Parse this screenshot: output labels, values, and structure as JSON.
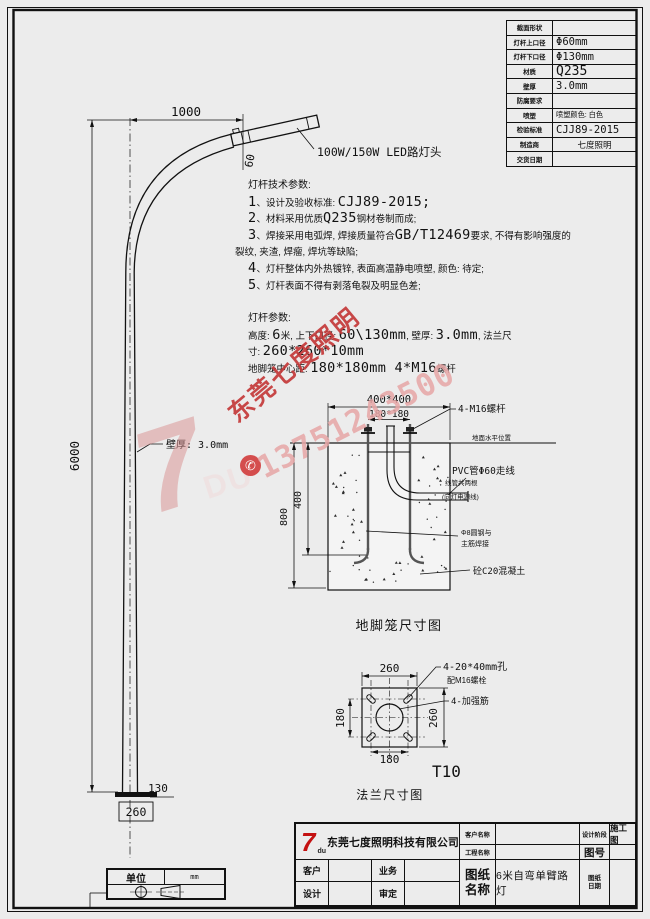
{
  "spec_table": {
    "rows": [
      {
        "label": "截面形状",
        "value": "",
        "cls": "v-cad"
      },
      {
        "label": "灯杆上口径",
        "value": "Φ60mm",
        "cls": "v-cad"
      },
      {
        "label": "灯杆下口径",
        "value": "Φ130mm",
        "cls": "v-cad"
      },
      {
        "label": "材质",
        "value": "Q235",
        "cls": "v-cad-lg"
      },
      {
        "label": "壁厚",
        "value": "3.0mm",
        "cls": "v-cad"
      },
      {
        "label": "防腐要求",
        "value": "",
        "cls": "v-cad"
      },
      {
        "label": "喷塑",
        "value": "喷塑颜色: 白色",
        "cls": "v-zh"
      },
      {
        "label": "检验标准",
        "value": "CJJ89-2015",
        "cls": "v-cad"
      },
      {
        "label": "制造商",
        "value": "七度照明",
        "cls": "v-zh-c"
      },
      {
        "label": "交货日期",
        "value": "",
        "cls": "v-cad"
      }
    ]
  },
  "tech_notes": {
    "title": "灯杆技术参数:",
    "lines": [
      [
        {
          "t": "1",
          "c": "L"
        },
        {
          "t": "、设计及验收标准: ",
          "c": "z"
        },
        {
          "t": "CJJ89-2015;",
          "c": "L"
        }
      ],
      [
        {
          "t": "2",
          "c": "L"
        },
        {
          "t": "、材料采用优质",
          "c": "z"
        },
        {
          "t": "Q235",
          "c": "L"
        },
        {
          "t": "钢材卷制而成;",
          "c": "z"
        }
      ],
      [
        {
          "t": "3",
          "c": "L"
        },
        {
          "t": "、焊接采用电弧焊, 焊接质量符合",
          "c": "z"
        },
        {
          "t": "GB/T12469",
          "c": "L"
        },
        {
          "t": "要求, 不得有影响强度的",
          "c": "z"
        }
      ],
      [
        {
          "t": "裂纹, 夹渣, 焊瘤, 焊坑等缺陷;",
          "c": "z"
        }
      ],
      [
        {
          "t": "4",
          "c": "L"
        },
        {
          "t": "、灯杆整体内外热镀锌, 表面高温静电喷塑, 颜色: 待定;",
          "c": "z"
        }
      ],
      [
        {
          "t": "5",
          "c": "L"
        },
        {
          "t": "、灯杆表面不得有剥落龟裂及明显色差;",
          "c": "z"
        }
      ]
    ]
  },
  "pole_params": {
    "title": "灯杆参数:",
    "lines": [
      [
        {
          "t": "高度: ",
          "c": "z"
        },
        {
          "t": "6",
          "c": "L"
        },
        {
          "t": "米, 上下口径: ",
          "c": "z"
        },
        {
          "t": "60\\130mm",
          "c": "L"
        },
        {
          "t": ", 壁厚: ",
          "c": "z"
        },
        {
          "t": "3.0mm",
          "c": "L"
        },
        {
          "t": ", 法兰尺",
          "c": "z"
        }
      ],
      [
        {
          "t": "寸: ",
          "c": "z"
        },
        {
          "t": "260*260*10mm",
          "c": "L"
        }
      ],
      [
        {
          "t": "地脚笼中心距: ",
          "c": "z"
        },
        {
          "t": "180*180mm  4*M16",
          "c": "L"
        },
        {
          "t": "螺杆",
          "c": "z"
        }
      ]
    ]
  },
  "pole": {
    "dim_width": "1000",
    "dim_height": "6000",
    "dim_lamp": "60",
    "lamp_label": "100W/150W LED路灯头",
    "wall_label": "壁厚: 3.0mm",
    "dim_bottom": "130",
    "dim_flange": "260"
  },
  "foundation": {
    "dim_outer": "400*400",
    "dim_inner": "180*180",
    "bolt_label": "4-M16螺杆",
    "ground_label": "地面水平位置",
    "pvc_l1": "PVC管Φ60走线",
    "pvc_l2": "线管共两根",
    "pvc_l3": "(向灯电源线)",
    "rebar_l1": "Φ8圆钢与",
    "rebar_l2": "主筋焊接",
    "concrete_label": "砼C20混凝土",
    "dim_400": "400",
    "dim_800": "800",
    "caption": "地脚笼尺寸图"
  },
  "flange": {
    "dim_top": "260",
    "dim_left": "180",
    "dim_bottom_d": "180",
    "dim_right": "260",
    "holes_l1": "4-20*40mm孔",
    "holes_l2": "配M16螺栓",
    "rib_label": "4-加强筋",
    "thickness": "T10",
    "caption": "法兰尺寸图"
  },
  "unit_box": {
    "label": "单位",
    "value": "mm"
  },
  "title_block": {
    "logo_7": "7",
    "logo_du": "du",
    "company": "东莞七度照明科技有限公司",
    "customer": "客户",
    "sales": "业务",
    "designer": "设计",
    "reviewer": "审定",
    "client_name": "客户名称",
    "project_name": "工程名称",
    "design_stage": "设计阶段",
    "stage_value": "施工图",
    "drawing_no_label": "图号",
    "sheet_l1": "图纸",
    "sheet_l2": "名称",
    "sheet_value": "6米自弯单臂路灯",
    "date_l1": "图纸",
    "date_l2": "日期"
  },
  "watermark": {
    "logo_7": "7",
    "logo_du": "DU",
    "brand": "东莞七度照明",
    "phone": "13751243500",
    "phone_icon": "✆",
    "brand_color": "#c43a3a"
  }
}
